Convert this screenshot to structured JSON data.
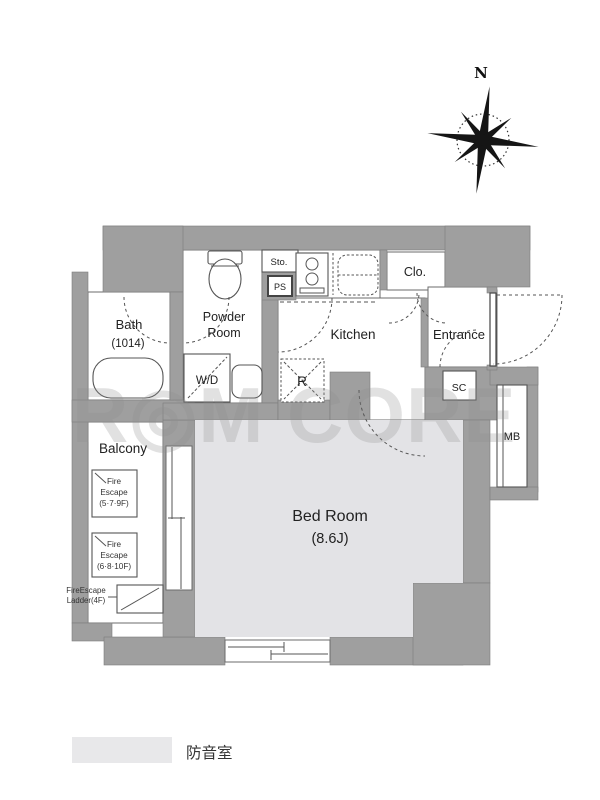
{
  "plan": {
    "compass_n": "N",
    "watermark": "R◎M CORE",
    "rooms": {
      "bath": "Bath",
      "bath_size": "(1014)",
      "powder_line1": "Powder",
      "powder_line2": "Room",
      "washer_dryer": "W/D",
      "storage": "Sto.",
      "pipe_space": "PS",
      "kitchen": "Kitchen",
      "refrigerator": "R",
      "closet": "Clo.",
      "entrance": "Entrance",
      "shoe_closet": "SC",
      "meter_box": "MB",
      "balcony": "Balcony",
      "bedroom": "Bed Room",
      "bedroom_size": "(8.6J)"
    },
    "fire_escape_1": [
      "Fire",
      "Escape",
      "(5·7·9F)"
    ],
    "fire_escape_2": [
      "Fire",
      "Escape",
      "(6·8·10F)"
    ],
    "fire_escape_ladder": [
      "FireEscape",
      "Ladder(4F)"
    ]
  },
  "legend": {
    "label": "防音室",
    "swatch_color": "#e8e8ea"
  },
  "colors": {
    "wall_gray": "#9f9f9f",
    "soundproof_room_fill": "#e3e3e6",
    "outline": "#6b6b6b",
    "label_text": "#222222"
  }
}
